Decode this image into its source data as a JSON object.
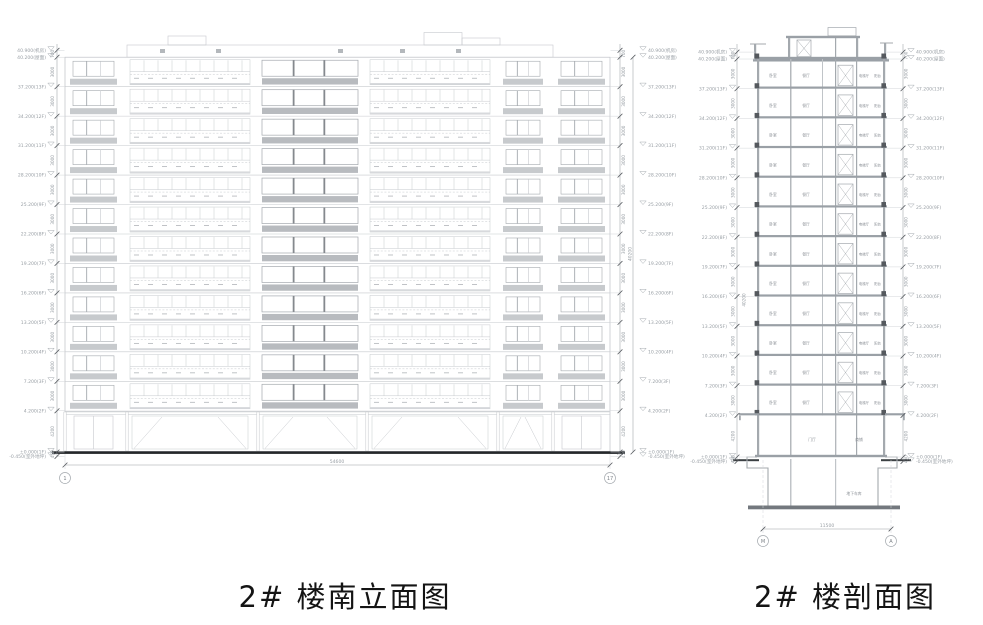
{
  "titles": {
    "elevation": "2# 楼南立面图",
    "section": "2# 楼剖面图"
  },
  "colors": {
    "line_light": "#c6c9cd",
    "line_mid": "#a4a9ae",
    "line_dark": "#55595e",
    "dim": "#9aa0a6",
    "text": "#9aa0a6",
    "room_text": "#8b9096",
    "spandrel": "#c7cacd",
    "spandrel_dark": "#b8bbbf",
    "slab": "#9aa0a6",
    "slab_dark": "#73787e",
    "ground": "#24272a",
    "title": "#141414"
  },
  "levels": [
    {
      "label": "40.900(机房)",
      "m": 40.9
    },
    {
      "label": "40.200(屋面)",
      "m": 40.2
    },
    {
      "label": "37.200(13F)",
      "m": 37.2
    },
    {
      "label": "34.200(12F)",
      "m": 34.2
    },
    {
      "label": "31.200(11F)",
      "m": 31.2
    },
    {
      "label": "28.200(10F)",
      "m": 28.2
    },
    {
      "label": "25.200(9F)",
      "m": 25.2
    },
    {
      "label": "22.200(8F)",
      "m": 22.2
    },
    {
      "label": "19.200(7F)",
      "m": 19.2
    },
    {
      "label": "16.200(6F)",
      "m": 16.2
    },
    {
      "label": "13.200(5F)",
      "m": 13.2
    },
    {
      "label": "10.200(4F)",
      "m": 10.2
    },
    {
      "label": "7.200(3F)",
      "m": 7.2
    },
    {
      "label": "4.200(2F)",
      "m": 4.2
    },
    {
      "label": "±0.000(1F)",
      "m": 0
    },
    {
      "label": "-0.450(室外地坪)",
      "m": -0.45
    }
  ],
  "floor_dims": [
    "700",
    "3000",
    "3000",
    "3000",
    "3000",
    "3000",
    "3000",
    "3000",
    "3000",
    "3000",
    "3000",
    "3000",
    "3000",
    "4200",
    "450"
  ],
  "elevation": {
    "grid_start": "1",
    "grid_end": "17",
    "width_dim": "54600",
    "height_dim": "40200"
  },
  "section": {
    "grid_start": "M",
    "grid_end": "A",
    "width_dim": "11500",
    "height_dim": "40200",
    "rooms": [
      "卧室",
      "餐厅",
      "电梯厅",
      "阳台"
    ],
    "first_floor_rooms": [
      "门厅",
      "商铺"
    ],
    "basement_room": "地下车库"
  }
}
